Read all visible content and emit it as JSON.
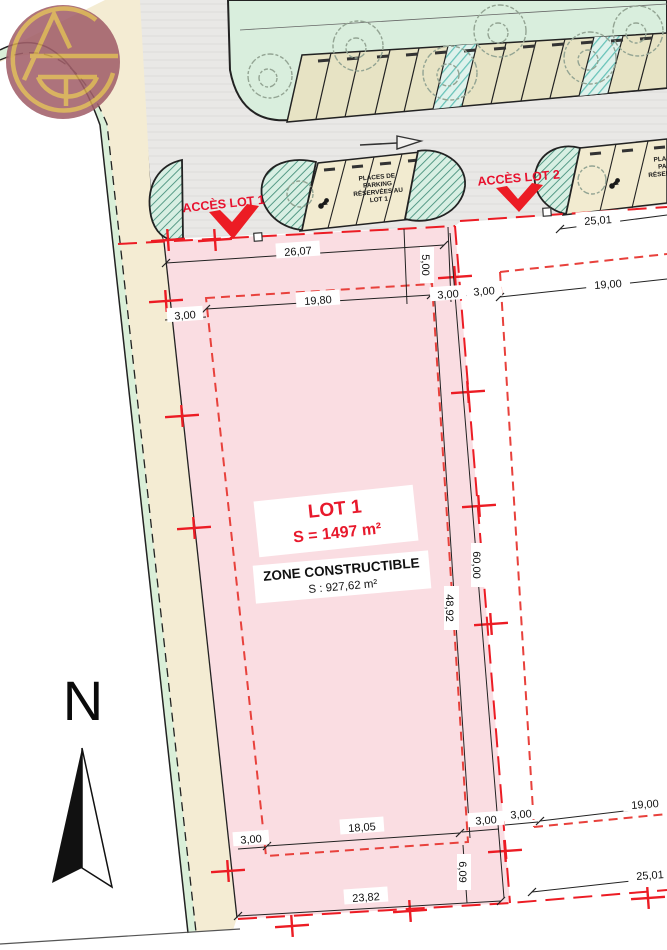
{
  "access": {
    "lot1_label": "ACCÈS LOT 1",
    "lot2_label": "ACCÈS LOT 2"
  },
  "lot1": {
    "title": "LOT 1",
    "area": "S = 1497 m²",
    "zone_title": "ZONE CONSTRUCTIBLE",
    "zone_area": "S : 927,62 m²"
  },
  "parking": {
    "lot1_lines": [
      "PLACES DE",
      "PARKING",
      "RÉSERVÉES AU",
      "LOT 1"
    ],
    "lot2_lines": [
      "PLACES DE",
      "PARKING",
      "RÉSERVÉES AU",
      "LOT"
    ]
  },
  "compass": {
    "north": "N"
  },
  "dimensions": {
    "d26_07": "26,07",
    "d25_01_top": "25,01",
    "d5_00": "5,00",
    "d3_00_nw": "3,00",
    "d19_80": "19,80",
    "d3_00_ne1": "3,00",
    "d3_00_ne2": "3,00",
    "d19_00_ne": "19,00",
    "d60_00": "60,00",
    "d48_92": "48,92",
    "d18_05": "18,05",
    "d3_00_sw": "3,00",
    "d3_00_se": "3,00",
    "d6_09": "6,09",
    "d23_82": "23,82",
    "d3_00_lot2": "3,00",
    "d19_00_se": "19,00",
    "d25_01_bottom": "25,01"
  },
  "colors": {
    "lot_fill": "#fadde2",
    "zone_fill": "#f6b9be",
    "boundary_red": "#ec1c24",
    "dashed_red": "#e8413c",
    "lot_text_red": "#e8192c",
    "road_gray": "#e9e8e6",
    "island_green": "#d9eedd",
    "parking_beige_island": "#e7e3c4",
    "parking_beige_lot": "#f2ebd0",
    "street_green": "#d9efd8",
    "street_beige": "#f4ecd3",
    "teal_hatch": "#66c2b8",
    "blob_hatch": "#47917c",
    "logo_maroon": "#a2606a",
    "logo_gold": "#d4a94c"
  }
}
